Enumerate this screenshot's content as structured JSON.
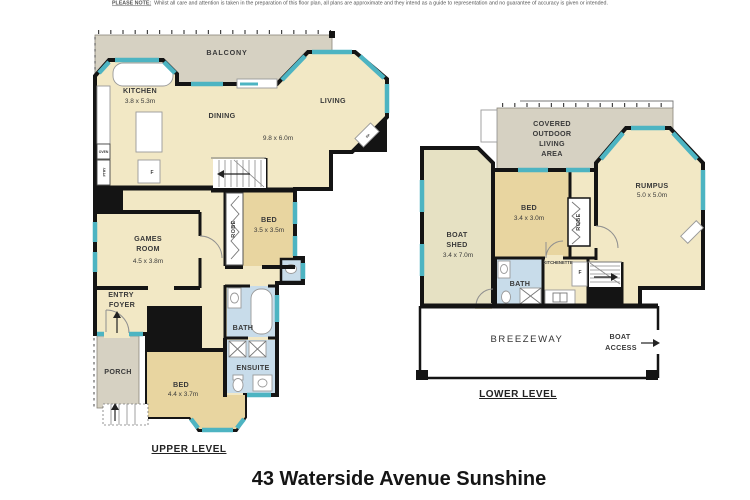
{
  "disclaimer": {
    "prefix": "PLEASE NOTE:",
    "text": "Whilst all care and attention is taken in the preparation of this floor plan, all plans are approximate and they intend as a guide to representation and no guarantee of accuracy is given or intended."
  },
  "title": "43 Waterside Avenue Sunshine",
  "colors": {
    "floor_cream": "#f2e8c5",
    "floor_tan": "#e8d5a0",
    "wet_area_blue": "#c8dcea",
    "outdoor_gray": "#d6d1c2",
    "boatshed_fill": "#e6e1c3",
    "window_teal": "#4db4c2",
    "wall_black": "#141414"
  },
  "levels": {
    "upper": {
      "label": "UPPER LEVEL",
      "balcony": "BALCONY",
      "kitchen": {
        "name": "KITCHEN",
        "dims": "3.8 x 5.3m"
      },
      "dining": "DINING",
      "living": "LIVING",
      "living_dims": "9.8 x 6.0m",
      "games": {
        "line1": "GAMES",
        "line2": "ROOM",
        "dims": "4.5 x 3.8m"
      },
      "bed1": {
        "name": "BED",
        "dims": "3.5 x 3.5m"
      },
      "robe": "ROBE",
      "bath": "BATH",
      "ensuite": "ENSUITE",
      "entry1": "ENTRY",
      "entry2": "FOYER",
      "porch": "PORCH",
      "bed2": {
        "name": "BED",
        "dims": "4.4 x 3.7m"
      },
      "oven": "OVEN",
      "pantry": "PTRY",
      "fridge": "F",
      "fireplace": "FP"
    },
    "lower": {
      "label": "LOWER LEVEL",
      "covered": {
        "line1": "COVERED",
        "line2": "OUTDOOR",
        "line3": "LIVING",
        "line4": "AREA"
      },
      "rumpus": {
        "name": "RUMPUS",
        "dims": "5.0 x 5.0m"
      },
      "bed": {
        "name": "BED",
        "dims": "3.4 x 3.0m"
      },
      "robe": "ROBE",
      "boatshed": {
        "line1": "BOAT",
        "line2": "SHED",
        "dims": "3.4 x 7.0m"
      },
      "bath": "BATH",
      "kitchenette": "KITCHENETTE",
      "fridge": "F",
      "breezeway": "BREEZEWAY",
      "boat_access1": "BOAT",
      "boat_access2": "ACCESS"
    }
  }
}
